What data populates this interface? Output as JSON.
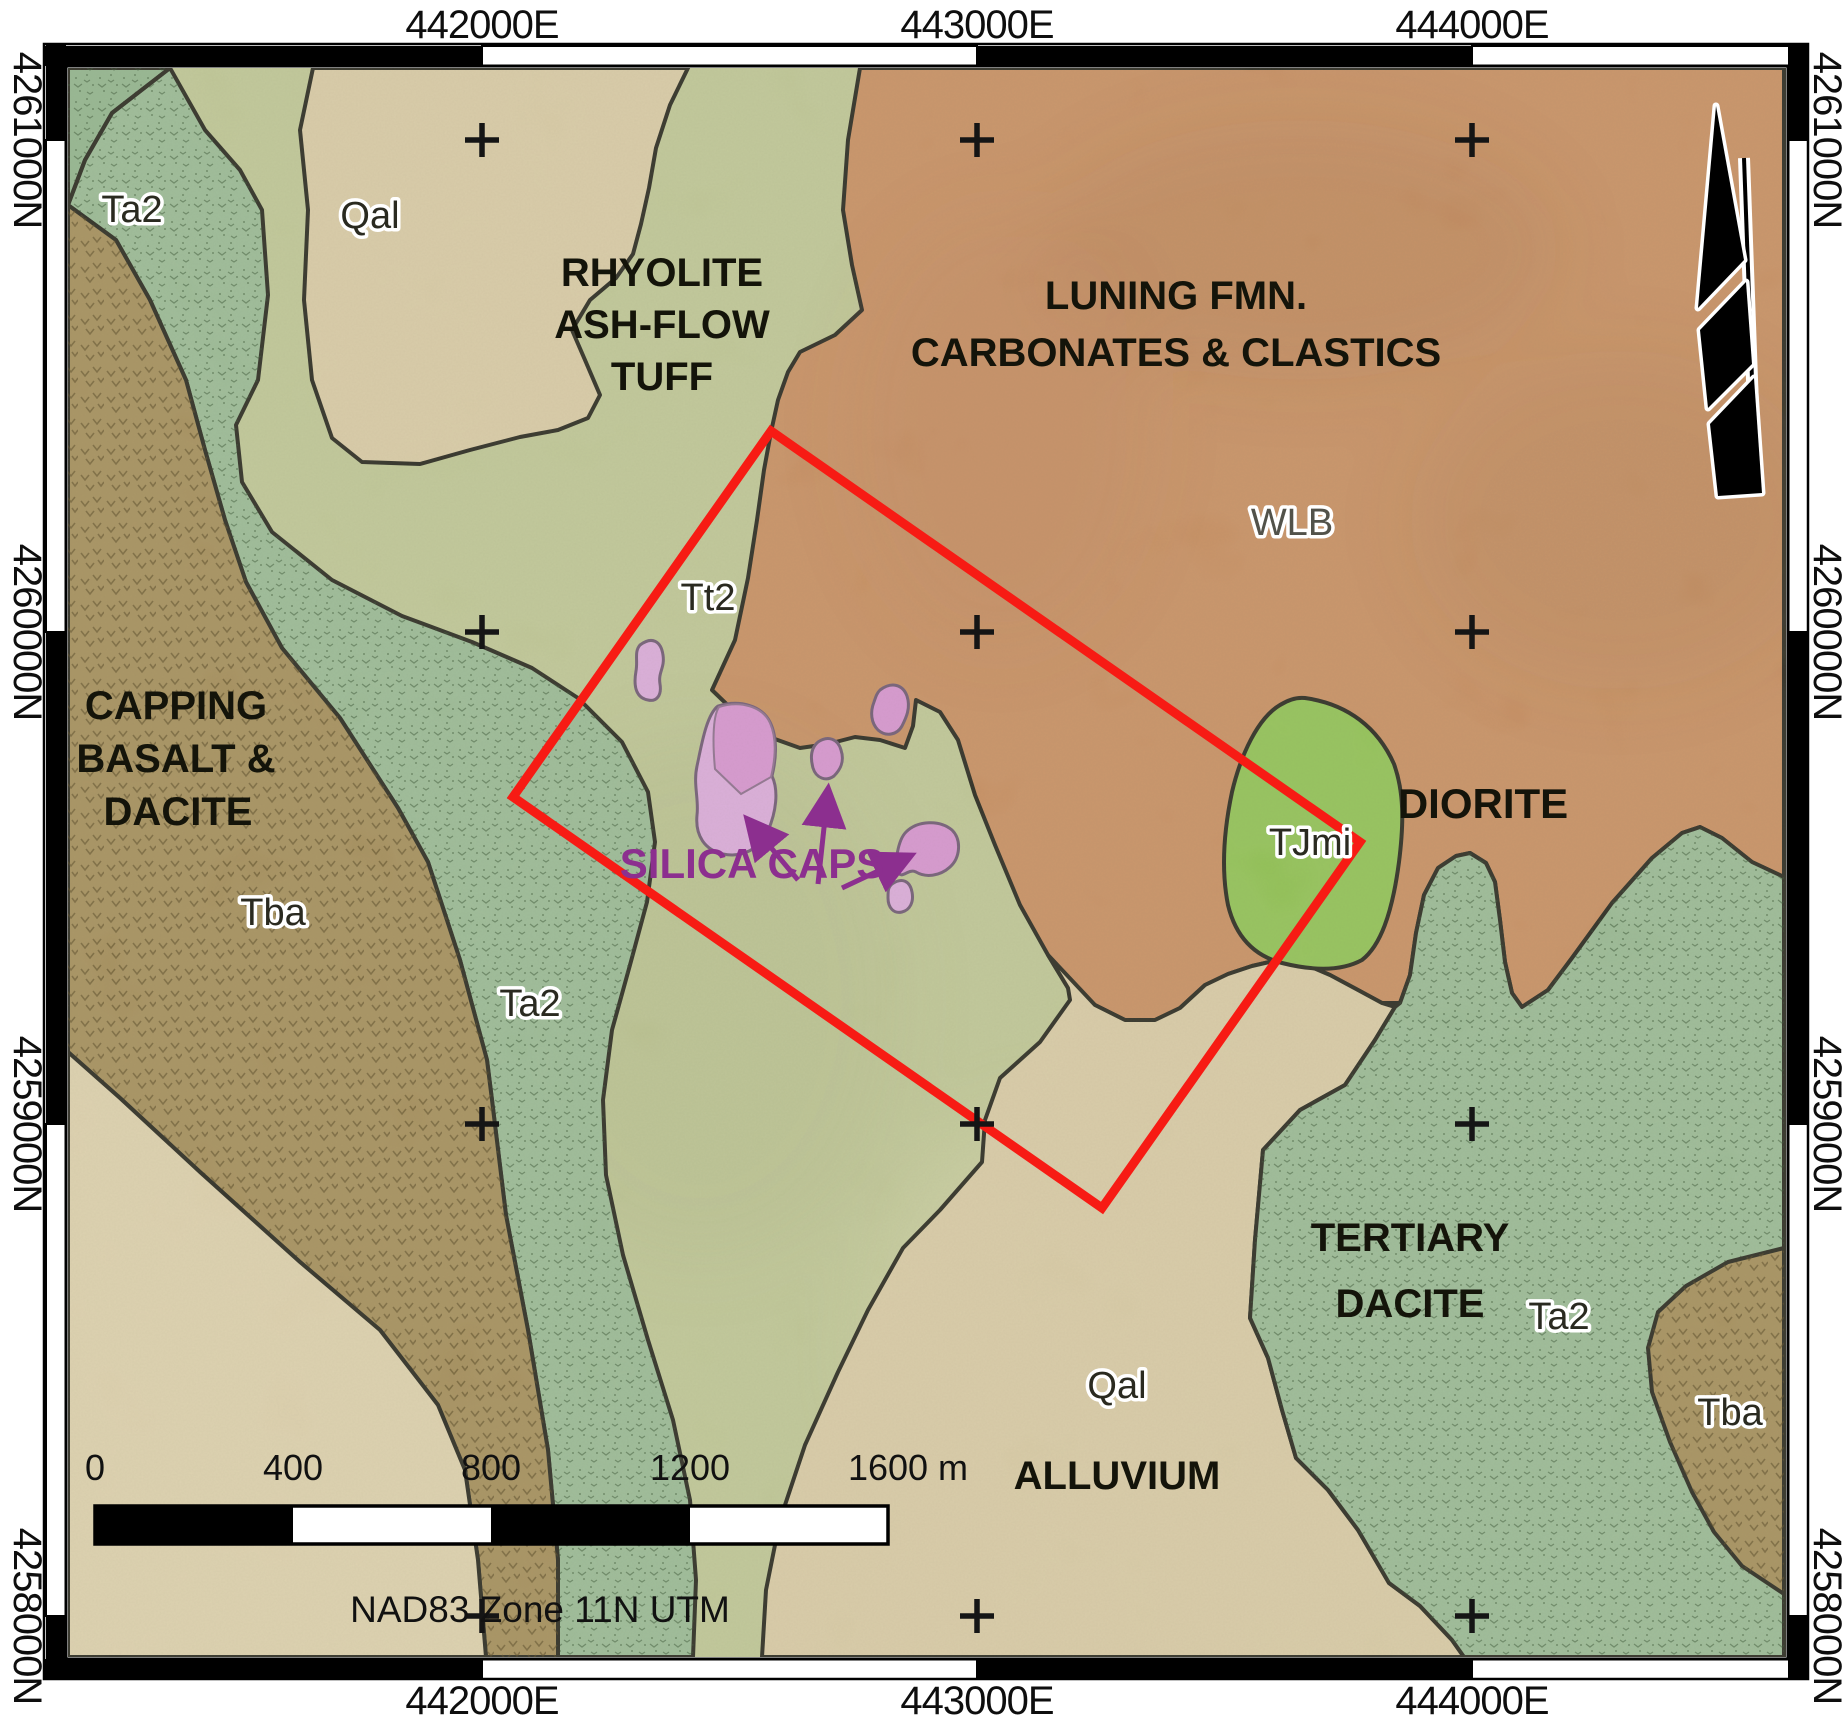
{
  "map_title": "Geologic map with silica caps study area",
  "grid": {
    "eastings": [
      "442000E",
      "443000E",
      "444000E"
    ],
    "northings": [
      "4261000N",
      "4260000N",
      "4259000N",
      "4258000N"
    ]
  },
  "formations": {
    "rhyolite": [
      "RHYOLITE",
      "ASH-FLOW",
      "TUFF"
    ],
    "luning": [
      "LUNING FMN.",
      "CARBONATES & CLASTICS"
    ],
    "capping": [
      "CAPPING",
      "BASALT &",
      "DACITE"
    ],
    "diorite": "DIORITE",
    "tertiary": [
      "TERTIARY",
      "DACITE"
    ],
    "alluvium": "ALLUVIUM",
    "silica": "SILICA CAPS"
  },
  "units": {
    "ta2_nw": "Ta2",
    "qal_nw": "Qal",
    "tt2": "Tt2",
    "tba_w": "Tba",
    "ta2_w": "Ta2",
    "wlb": "WLB",
    "tjmi": "TJmi",
    "ta2_se": "Ta2",
    "tba_se": "Tba",
    "qal_s": "Qal"
  },
  "scale_bar": {
    "labels": [
      "0",
      "400",
      "800",
      "1200"
    ],
    "end_label": "1600 m",
    "datum": "NAD83 Zone 11N UTM"
  },
  "colors": {
    "qal": "#d7c9a3",
    "qal_light": "#dccfab",
    "tt2": "#bdc593",
    "ta2": "#97b892",
    "ta2_dark": "#8fb28b",
    "tba": "#a28b57",
    "luning": "#c68c5e",
    "tjmi": "#8ec050",
    "silica_light": "#d9a8da",
    "silica_dark": "#d591cf",
    "silica_outline": "#6b5570",
    "boundary": "#23231a",
    "study_area_red": "#f71b14",
    "purple": "#8c2f8f",
    "black": "#151515",
    "white": "#ffffff"
  }
}
